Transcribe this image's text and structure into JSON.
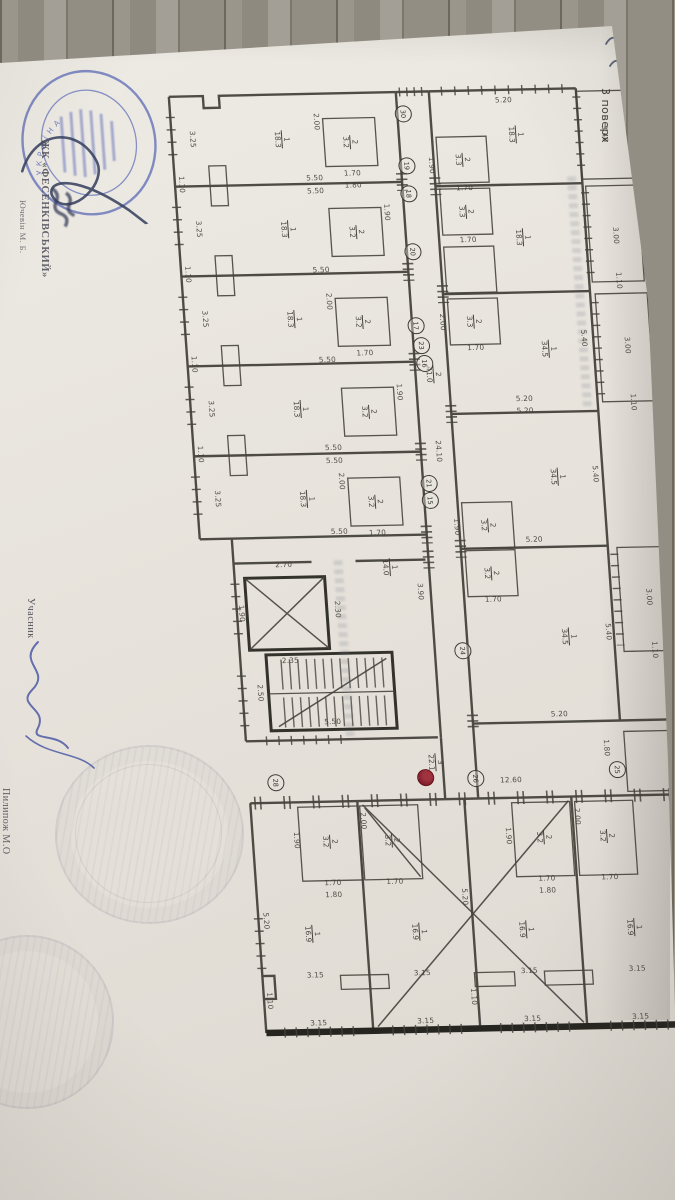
{
  "annotations": {
    "floor": "3 поверх",
    "complex": "ЖК «ФЕСЕНКІВСЬКИЙ»",
    "person": "Ючевін М. Б.",
    "participant": "Учасник",
    "participant_name": "Пилипож М.О"
  },
  "stamp": {
    "country": "УКРАЇНА",
    "ink_color": "#5565b4"
  },
  "plan": {
    "ink_color": "#413f38",
    "red_marker_color": "#8e1f2c",
    "labels": [
      {
        "t": "3.25",
        "x": 29,
        "y": 55,
        "o": "v"
      },
      {
        "t": "3.25",
        "x": 29,
        "y": 145,
        "o": "v"
      },
      {
        "t": "3.25",
        "x": 29,
        "y": 235,
        "o": "v"
      },
      {
        "t": "3.25",
        "x": 29,
        "y": 325,
        "o": "v"
      },
      {
        "t": "3.25",
        "x": 29,
        "y": 415,
        "o": "v"
      },
      {
        "t": "1.10",
        "x": 15,
        "y": 100,
        "o": "v"
      },
      {
        "t": "1.10",
        "x": 15,
        "y": 190,
        "o": "v"
      },
      {
        "t": "1.10",
        "x": 15,
        "y": 280,
        "o": "v"
      },
      {
        "t": "1.10",
        "x": 15,
        "y": 370,
        "o": "v"
      },
      {
        "t": "5.50",
        "x": 148,
        "y": 96,
        "o": "h"
      },
      {
        "t": "5.50",
        "x": 148,
        "y": 109,
        "o": "h"
      },
      {
        "t": "5.50",
        "x": 148,
        "y": 188,
        "o": "h"
      },
      {
        "t": "5.50",
        "x": 148,
        "y": 278,
        "o": "h"
      },
      {
        "t": "5.50",
        "x": 148,
        "y": 366,
        "o": "h"
      },
      {
        "t": "5.50",
        "x": 148,
        "y": 379,
        "o": "h"
      },
      {
        "t": "5.50",
        "x": 148,
        "y": 450,
        "o": "h"
      },
      {
        "t": "2.00",
        "x": 154,
        "y": 40,
        "o": "v"
      },
      {
        "t": "2.00",
        "x": 154,
        "y": 220,
        "o": "v"
      },
      {
        "t": "2.00",
        "x": 154,
        "y": 400,
        "o": "v"
      },
      {
        "t": "1.90",
        "x": 218,
        "y": 132,
        "o": "v"
      },
      {
        "t": "1.90",
        "x": 218,
        "y": 312,
        "o": "v"
      },
      {
        "t": "1.70",
        "x": 186,
        "y": 92,
        "o": "h"
      },
      {
        "t": "1.70",
        "x": 186,
        "y": 272,
        "o": "h"
      },
      {
        "t": "1.70",
        "x": 186,
        "y": 452,
        "o": "h"
      },
      {
        "t": "1.80",
        "x": 186,
        "y": 104,
        "o": "h"
      },
      {
        "t": "24.10",
        "x": 253,
        "y": 372,
        "o": "v"
      },
      {
        "t": "5.20",
        "x": 342,
        "y": 22,
        "o": "h"
      },
      {
        "t": "5.20",
        "x": 342,
        "y": 321,
        "o": "h"
      },
      {
        "t": "5.20",
        "x": 342,
        "y": 333,
        "o": "h"
      },
      {
        "t": "5.20",
        "x": 342,
        "y": 462,
        "o": "h"
      },
      {
        "t": "5.20",
        "x": 355,
        "y": 637,
        "o": "h"
      },
      {
        "t": "3.40",
        "x": 441,
        "y": 58,
        "o": "v"
      },
      {
        "t": "3.00",
        "x": 445,
        "y": 160,
        "o": "v"
      },
      {
        "t": "3.00",
        "x": 449,
        "y": 270,
        "o": "v"
      },
      {
        "t": "3.00",
        "x": 453,
        "y": 522,
        "o": "v"
      },
      {
        "t": "1.10",
        "x": 445,
        "y": 205,
        "o": "v"
      },
      {
        "t": "1.10",
        "x": 451,
        "y": 327,
        "o": "v"
      },
      {
        "t": "1.10",
        "x": 455,
        "y": 575,
        "o": "v"
      },
      {
        "t": "1.10",
        "x": 466,
        "y": 713,
        "o": "v"
      },
      {
        "t": "5.40",
        "x": 406,
        "y": 262,
        "o": "v"
      },
      {
        "t": "5.40",
        "x": 408,
        "y": 398,
        "o": "v"
      },
      {
        "t": "5.40",
        "x": 410,
        "y": 556,
        "o": "v"
      },
      {
        "t": "1.70",
        "x": 297,
        "y": 109,
        "o": "h"
      },
      {
        "t": "1.70",
        "x": 297,
        "y": 161,
        "o": "h"
      },
      {
        "t": "1.70",
        "x": 297,
        "y": 269,
        "o": "h"
      },
      {
        "t": "1.70",
        "x": 297,
        "y": 521,
        "o": "h"
      },
      {
        "t": "1.90",
        "x": 266,
        "y": 86,
        "o": "v"
      },
      {
        "t": "1.90",
        "x": 266,
        "y": 448,
        "o": "v"
      },
      {
        "t": "2.00",
        "x": 266,
        "y": 243,
        "o": "v"
      },
      {
        "t": "1.80",
        "x": 400,
        "y": 672,
        "o": "v"
      },
      {
        "t": "2.70",
        "x": 90,
        "y": 482,
        "o": "h"
      },
      {
        "t": "2.35",
        "x": 90,
        "y": 578,
        "o": "h"
      },
      {
        "t": "2.30",
        "x": 141,
        "y": 528,
        "o": "v"
      },
      {
        "t": "1.90",
        "x": 45,
        "y": 530,
        "o": "v"
      },
      {
        "t": "3.90",
        "x": 225,
        "y": 512,
        "o": "v"
      },
      {
        "t": "2.50",
        "x": 58,
        "y": 610,
        "o": "v"
      },
      {
        "t": "5.50",
        "x": 128,
        "y": 640,
        "o": "h"
      },
      {
        "t": "12.60",
        "x": 302,
        "y": 702,
        "o": "h"
      },
      {
        "t": "5.20",
        "x": 48,
        "y": 838,
        "o": "v"
      },
      {
        "t": "5.20",
        "x": 248,
        "y": 818,
        "o": "v"
      },
      {
        "t": "5.20",
        "x": 458,
        "y": 838,
        "o": "v"
      },
      {
        "t": "3.15",
        "x": 93,
        "y": 893,
        "o": "h"
      },
      {
        "t": "3.15",
        "x": 200,
        "y": 893,
        "o": "h"
      },
      {
        "t": "3.15",
        "x": 307,
        "y": 893,
        "o": "h"
      },
      {
        "t": "3.15",
        "x": 415,
        "y": 893,
        "o": "h"
      },
      {
        "t": "3.15",
        "x": 93,
        "y": 941,
        "o": "h"
      },
      {
        "t": "3.15",
        "x": 200,
        "y": 941,
        "o": "h"
      },
      {
        "t": "3.15",
        "x": 307,
        "y": 941,
        "o": "h"
      },
      {
        "t": "3.15",
        "x": 415,
        "y": 941,
        "o": "h"
      },
      {
        "t": "1.10",
        "x": 46,
        "y": 918,
        "o": "v"
      },
      {
        "t": "1.10",
        "x": 250,
        "y": 918,
        "o": "v"
      },
      {
        "t": "1.10",
        "x": 462,
        "y": 918,
        "o": "v"
      },
      {
        "t": "1.70",
        "x": 117,
        "y": 801,
        "o": "h"
      },
      {
        "t": "1.70",
        "x": 179,
        "y": 801,
        "o": "h"
      },
      {
        "t": "1.70",
        "x": 331,
        "y": 801,
        "o": "h"
      },
      {
        "t": "1.70",
        "x": 394,
        "y": 801,
        "o": "h"
      },
      {
        "t": "1.80",
        "x": 117,
        "y": 813,
        "o": "h"
      },
      {
        "t": "1.80",
        "x": 331,
        "y": 813,
        "o": "h"
      },
      {
        "t": "1.90",
        "x": 84,
        "y": 758,
        "o": "v"
      },
      {
        "t": "1.90",
        "x": 296,
        "y": 758,
        "o": "v"
      },
      {
        "t": "2.00",
        "x": 152,
        "y": 740,
        "o": "v"
      },
      {
        "t": "2.00",
        "x": 366,
        "y": 740,
        "o": "v"
      }
    ],
    "fractions": [
      {
        "n": "1",
        "d": "18.3",
        "x": 118,
        "y": 57
      },
      {
        "n": "1",
        "d": "18.3",
        "x": 118,
        "y": 147
      },
      {
        "n": "1",
        "d": "18.3",
        "x": 118,
        "y": 237
      },
      {
        "n": "1",
        "d": "18.3",
        "x": 118,
        "y": 327
      },
      {
        "n": "1",
        "d": "18.3",
        "x": 118,
        "y": 417
      },
      {
        "n": "1",
        "d": "18.3",
        "x": 352,
        "y": 57
      },
      {
        "n": "1",
        "d": "18.3",
        "x": 352,
        "y": 160
      },
      {
        "n": "2",
        "d": "3.2",
        "x": 186,
        "y": 61
      },
      {
        "n": "2",
        "d": "3.2",
        "x": 186,
        "y": 151
      },
      {
        "n": "2",
        "d": "3.2",
        "x": 186,
        "y": 241
      },
      {
        "n": "2",
        "d": "3.2",
        "x": 186,
        "y": 331
      },
      {
        "n": "2",
        "d": "3.2",
        "x": 186,
        "y": 421
      },
      {
        "n": "2",
        "d": "3.3",
        "x": 297,
        "y": 81
      },
      {
        "n": "2",
        "d": "3.3",
        "x": 297,
        "y": 133
      },
      {
        "n": "2",
        "d": "3.3",
        "x": 297,
        "y": 243
      },
      {
        "n": "2",
        "d": "3.2",
        "x": 297,
        "y": 447
      },
      {
        "n": "2",
        "d": "3.2",
        "x": 297,
        "y": 495
      },
      {
        "n": "1",
        "d": "34.5",
        "x": 370,
        "y": 272
      },
      {
        "n": "1",
        "d": "34.5",
        "x": 370,
        "y": 400
      },
      {
        "n": "1",
        "d": "34.5",
        "x": 370,
        "y": 560
      },
      {
        "n": "1",
        "d": "14.0",
        "x": 196,
        "y": 487
      },
      {
        "n": "2",
        "d": "41.0",
        "x": 253,
        "y": 295
      },
      {
        "n": "3",
        "d": "22.1",
        "x": 228,
        "y": 683
      },
      {
        "n": "1",
        "d": "16.9",
        "x": 93,
        "y": 852
      },
      {
        "n": "1",
        "d": "16.9",
        "x": 200,
        "y": 852
      },
      {
        "n": "1",
        "d": "16.9",
        "x": 307,
        "y": 852
      },
      {
        "n": "1",
        "d": "16.9",
        "x": 415,
        "y": 852
      },
      {
        "n": "2",
        "d": "3.2",
        "x": 117,
        "y": 760
      },
      {
        "n": "2",
        "d": "3.2",
        "x": 179,
        "y": 760
      },
      {
        "n": "2",
        "d": "3.2",
        "x": 331,
        "y": 760
      },
      {
        "n": "2",
        "d": "3.2",
        "x": 394,
        "y": 760
      }
    ],
    "markers": [
      {
        "n": "30",
        "x": 241,
        "y": 34
      },
      {
        "n": "19",
        "x": 241,
        "y": 86
      },
      {
        "n": "18",
        "x": 241,
        "y": 114
      },
      {
        "n": "20",
        "x": 241,
        "y": 172
      },
      {
        "n": "17",
        "x": 239,
        "y": 246
      },
      {
        "n": "23",
        "x": 243,
        "y": 266
      },
      {
        "n": "16",
        "x": 245,
        "y": 284
      },
      {
        "n": "21",
        "x": 241,
        "y": 404
      },
      {
        "n": "15",
        "x": 241,
        "y": 421
      },
      {
        "n": "24",
        "x": 263,
        "y": 572
      },
      {
        "n": "28",
        "x": 67,
        "y": 700
      },
      {
        "n": "",
        "x": 217,
        "y": 698,
        "red": true
      },
      {
        "n": "26",
        "x": 267,
        "y": 700
      },
      {
        "n": "25",
        "x": 409,
        "y": 694
      }
    ]
  }
}
